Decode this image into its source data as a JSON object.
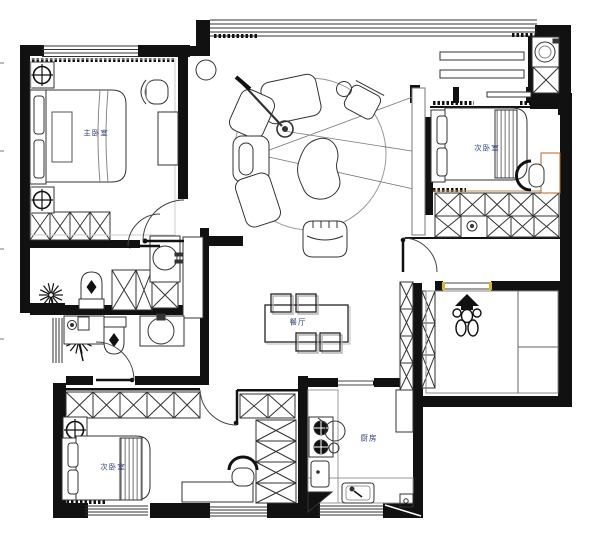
{
  "document": {
    "type": "apartment floor plan drawing",
    "language": "zh-CN"
  },
  "colors": {
    "background": "#ffffff",
    "wall": "#111111",
    "line": "#333333",
    "light_line": "#999999",
    "label_text": "#2e3f7a",
    "accent_yellow": "#d8b62a",
    "accent_orange": "#b06a2a"
  },
  "rooms": {
    "master_bedroom": {
      "label": "主卧室"
    },
    "second_bedroom_right": {
      "label": "次卧室"
    },
    "second_bedroom_left": {
      "label": "次卧室"
    },
    "dining_room": {
      "label": "餐厅"
    },
    "kitchen": {
      "label": "厨房"
    }
  },
  "furniture_icons": [
    "double-bed",
    "single-bed",
    "pillow",
    "wardrobe-x-cell",
    "ceiling-light-symbol",
    "sectional-sofa",
    "organic-coffee-table",
    "floor-lamp",
    "tub-armchair",
    "side-chair",
    "round-rug",
    "sight-lines",
    "dining-table",
    "dining-chair",
    "toilet",
    "wash-basin",
    "bathroom-cabinet",
    "washing-machine",
    "gas-stove",
    "wok",
    "kitchen-sink",
    "cutting-board",
    "desk",
    "desk-chair",
    "dressing-stool",
    "plant-starburst",
    "statue-figurine",
    "door-swing",
    "window-band",
    "curtain-track",
    "shelf-bar"
  ]
}
